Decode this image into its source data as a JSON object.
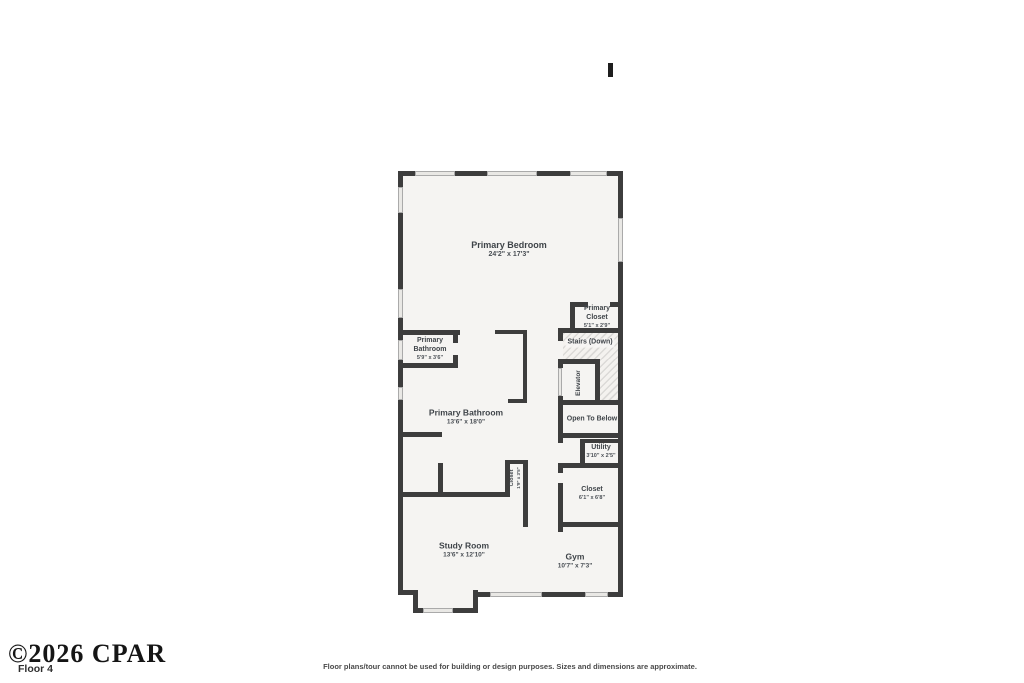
{
  "page": {
    "watermark": "©2026 CPAR",
    "floor_label": "Floor 4",
    "disclaimer": "Floor plans/tour cannot be used for building or design purposes. Sizes and dimensions are approximate."
  },
  "colors": {
    "wall": "#3d3d3d",
    "floor": "#f5f4f2",
    "window": "#e9e8e5",
    "label_text": "#3f4449"
  },
  "rooms": {
    "primary_bedroom": {
      "name": "Primary Bedroom",
      "dims": "24'2\" x 17'3\""
    },
    "primary_bathroom_small": {
      "name": "Primary Bathroom",
      "dims": "5'9\" x 3'6\""
    },
    "primary_bathroom": {
      "name": "Primary Bathroom",
      "dims": "13'6\" x 18'0\""
    },
    "primary_closet": {
      "name": "Primary Closet",
      "dims": "5'1\" x 2'9\""
    },
    "stairs": {
      "name": "Stairs (Down)"
    },
    "elevator": {
      "name": "Elevator"
    },
    "open_to_below": {
      "name": "Open To Below"
    },
    "utility": {
      "name": "Utility",
      "dims": "3'10\" x 2'5\""
    },
    "closet_small": {
      "name": "Closet",
      "dims": "1'9\" x 3'5\""
    },
    "closet": {
      "name": "Closet",
      "dims": "6'1\" x 6'8\""
    },
    "study_room": {
      "name": "Study Room",
      "dims": "13'6\" x 12'10\""
    },
    "gym": {
      "name": "Gym",
      "dims": "10'7\" x 7'3\""
    }
  }
}
